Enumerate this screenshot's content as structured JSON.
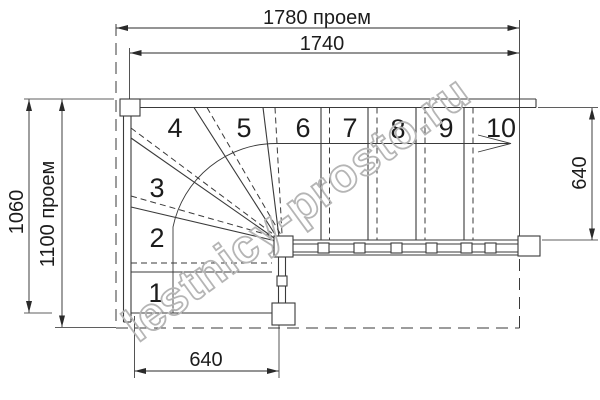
{
  "dimensions": {
    "top_opening": "1780 проем",
    "top_stair": "1740",
    "left_outer": "1060",
    "left_opening": "1100 проем",
    "right_width": "640",
    "bottom_width": "640"
  },
  "steps": {
    "labels": [
      "1",
      "2",
      "3",
      "4",
      "5",
      "6",
      "7",
      "8",
      "9",
      "10"
    ]
  },
  "watermark": {
    "text": "lestnicy-prosto.ru",
    "color": "#b5b5b5"
  },
  "colors": {
    "line": "#3a3a3a",
    "dimension_text": "#1c1c1c",
    "background": "#ffffff"
  }
}
